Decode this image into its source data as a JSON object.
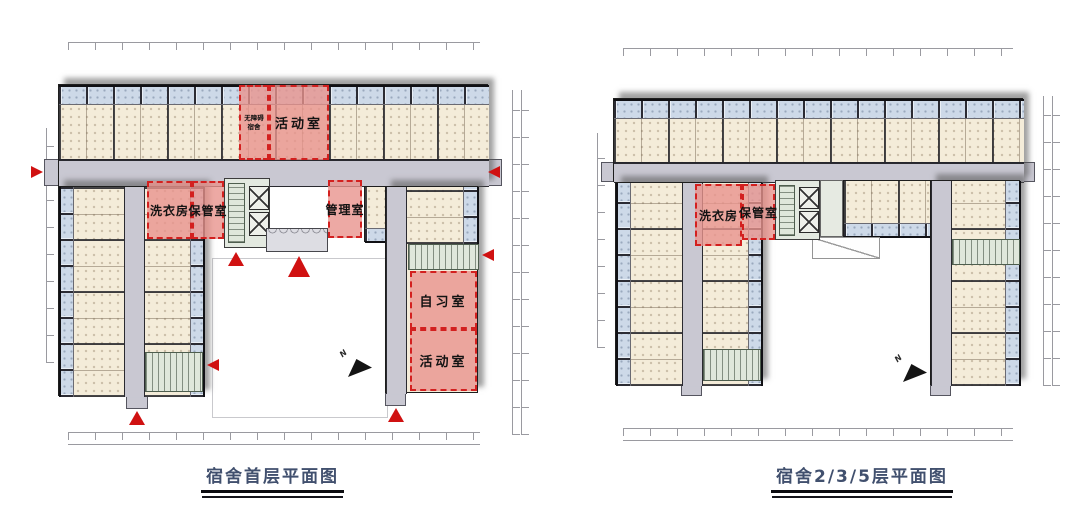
{
  "colors": {
    "room_fill": "#f4ecd9",
    "bath_pod_fill": "#cdd9e8",
    "corridor_fill": "#c9c8d2",
    "highlight_fill": "#ee9a93",
    "highlight_border": "#d3201f",
    "stair_core_fill": "#dfe7db",
    "building_shadow": "#555555",
    "entrance_arrow": "#d01111",
    "north_arrow": "#141414",
    "caption_text": "#41506e"
  },
  "plans": {
    "first_floor": {
      "caption": "宿舍首层平面图",
      "north_label": "N",
      "rooms": {
        "accessible_dorm": "无障碍宿舍",
        "activity_room_top": "活动室",
        "laundry_room": "洗衣房",
        "storage_room": "保管室",
        "management_room": "管理室",
        "study_room": "自习室",
        "activity_room_wing": "活动室"
      }
    },
    "upper_floor": {
      "caption": "宿舍2/3/5层平面图",
      "north_label": "N",
      "rooms": {
        "laundry_room": "洗衣房",
        "storage_room": "保管室"
      }
    }
  }
}
